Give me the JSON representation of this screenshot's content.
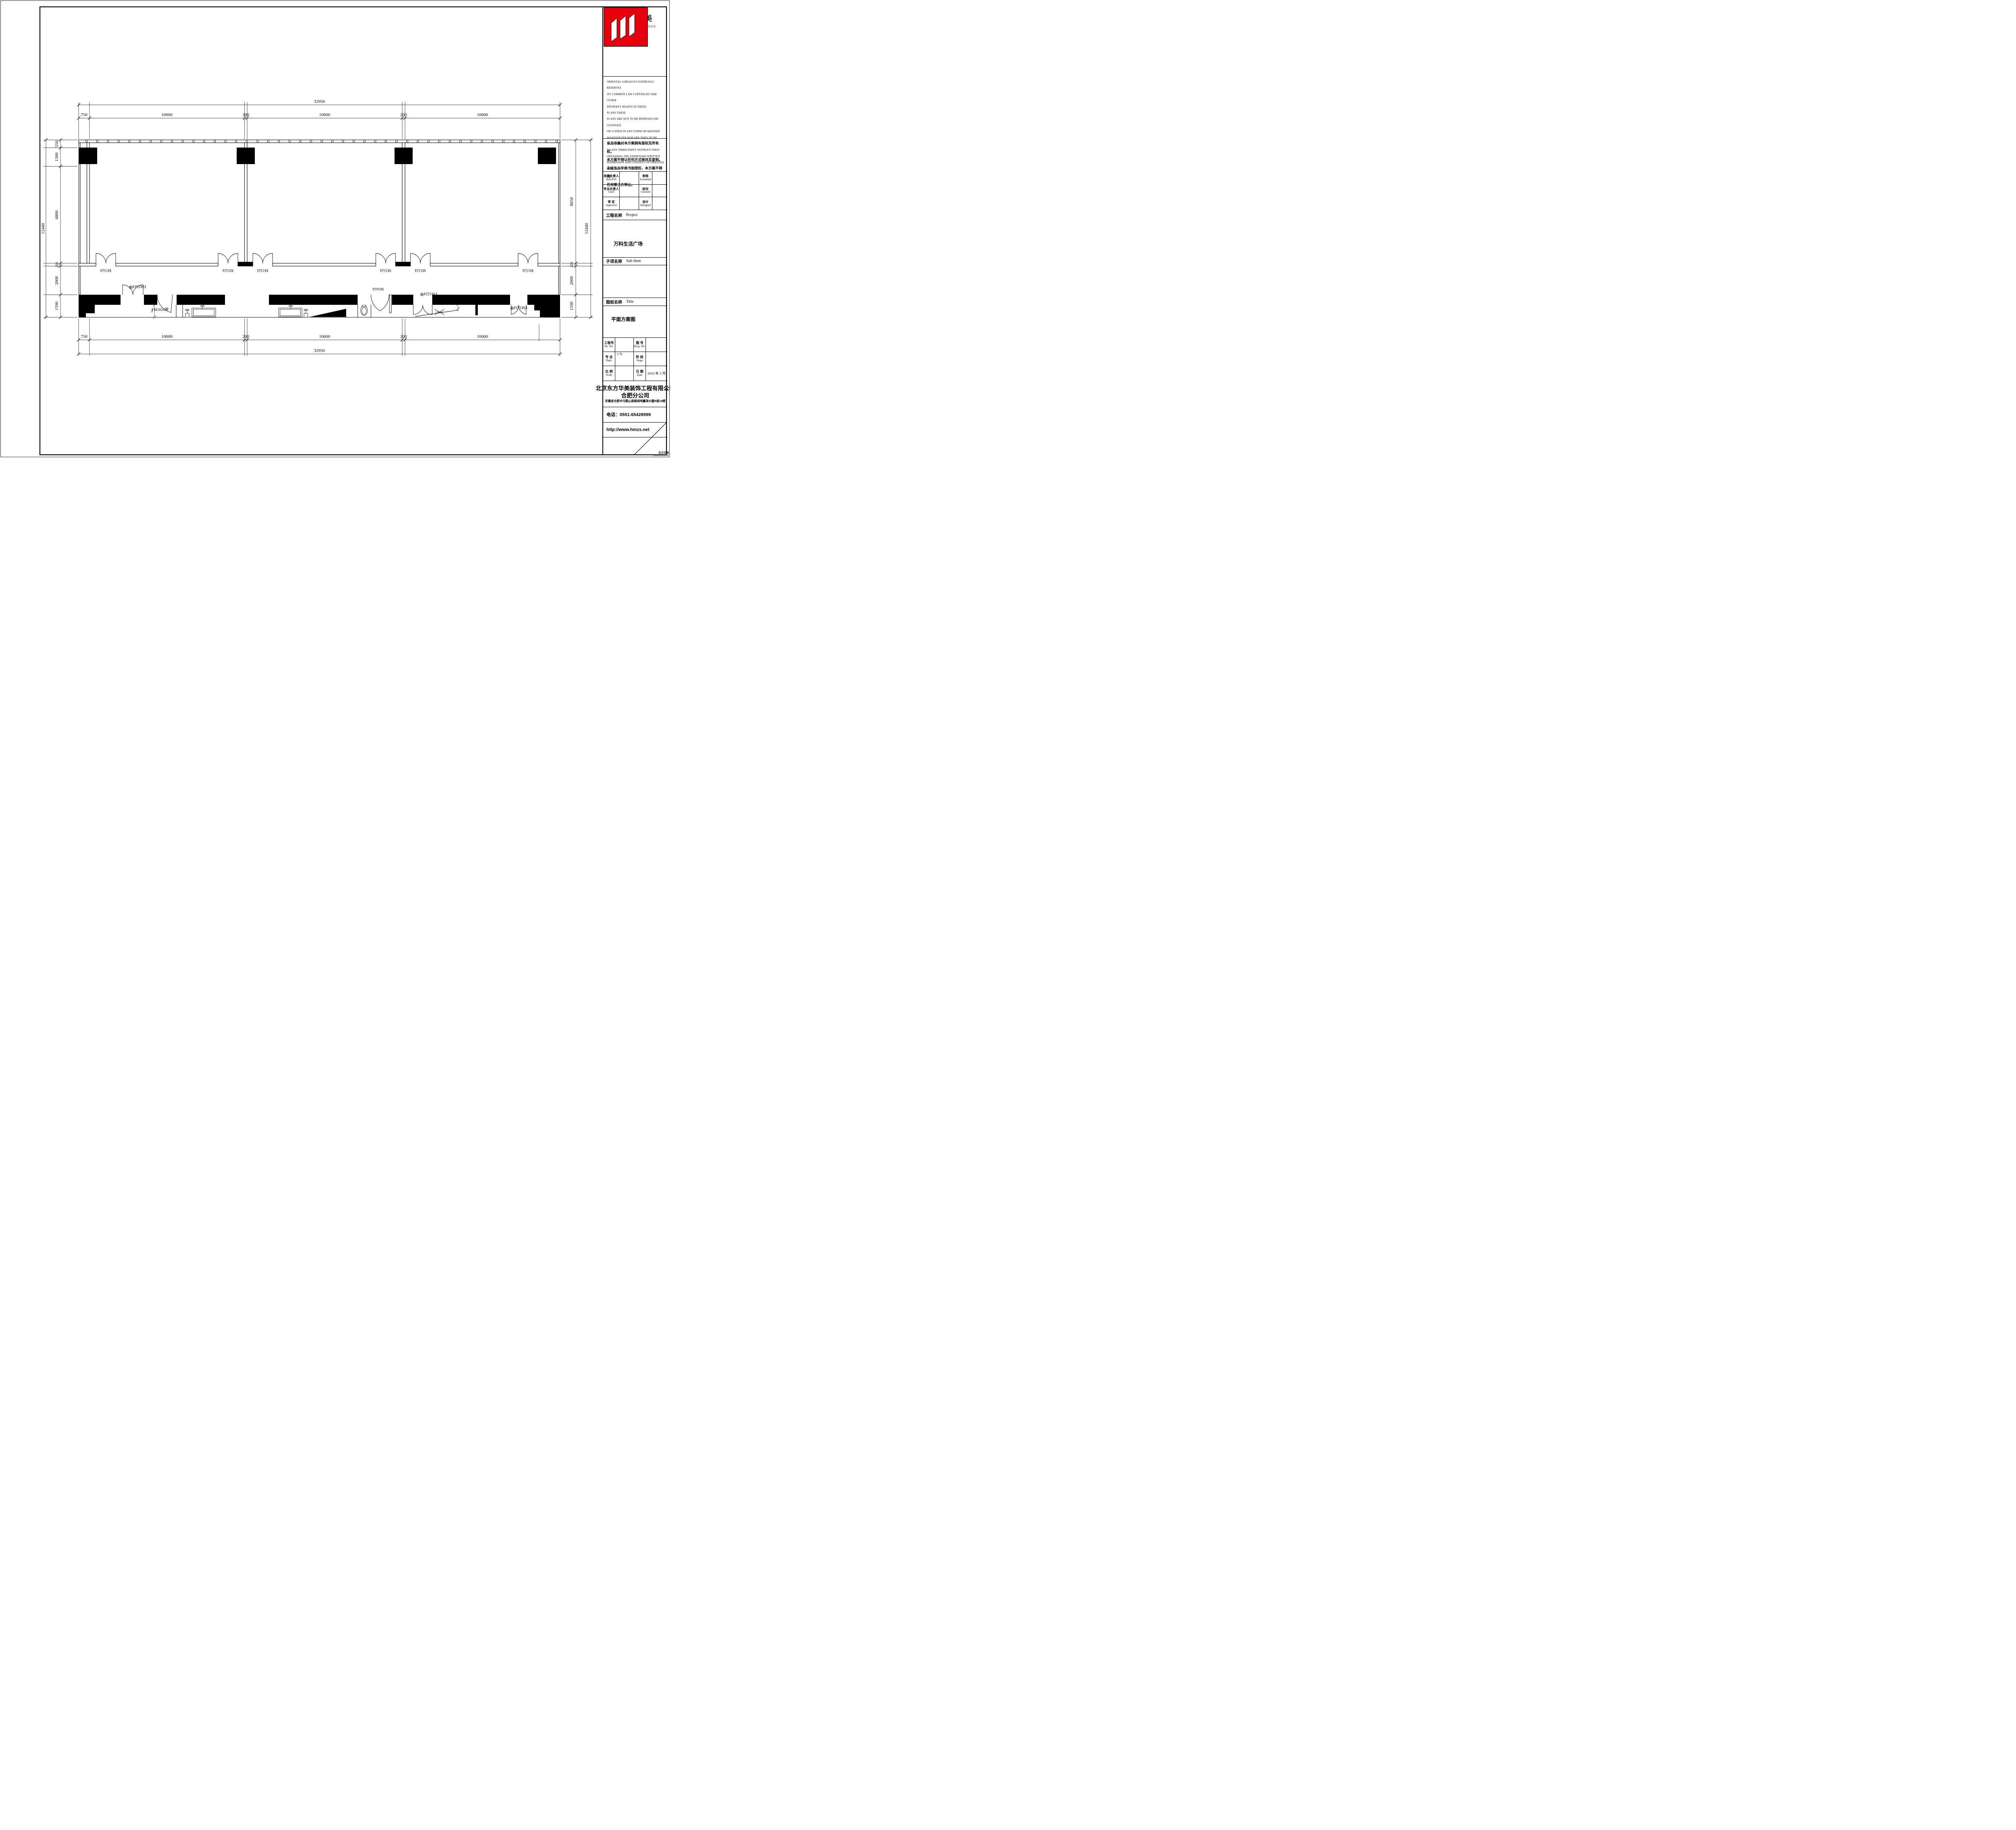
{
  "title_block": {
    "logo": {
      "cn": "东方华美",
      "en": "Oriental Gorgeous",
      "brand_red": "#e8000d"
    },
    "copyright_en_lines": [
      "ORIENTAL GORGEOUS EXPRESSLY RESERVES",
      "ITS COMMON LAW COPYRIGHT AND OTHER",
      "PROPERTY RIGHTS IN THESE PLANS.THESE",
      "PLANS ARE NOT TO BE REPRODUCED CHANGED",
      "OR COPIED IN ANY FORM OR MANNER",
      "WHATSOEVER.NOR ARE THEY TO BE ASSIGHED",
      "TO ANY THIRD PARTY WITHOUT FIRST",
      "OBTAINING THE EXPRESSED WRITTEN",
      "PERMISSION AND CONSENT OF ORIENTAL",
      "GORGEOUS"
    ],
    "copyright_cn_lines": [
      "东方华美对本方案拥有版权及所有权。",
      "本方案不得以任何方式修改及复制。",
      "未经东方华美书面授权，本方案不得向",
      "任何第三方转让。"
    ],
    "personnel": {
      "item_prin_cn": "项目负责人",
      "item_prin_en": "Item.Prin",
      "examined_cn": "审核",
      "examined_en": "Examined",
      "chief_cn": "专业负责人",
      "chief_en": "Chief",
      "checked_cn": "校对",
      "checked_en": "Checked",
      "approved_cn": "审 定",
      "approved_en": "Approved",
      "designed_cn": "设计",
      "designed_en": "Designed"
    },
    "project": {
      "label_cn": "工程名称",
      "label_en": "Project",
      "value": "万科生活广场"
    },
    "sub_item": {
      "label_cn": "子项名称",
      "label_en": "Sub Item",
      "value": ""
    },
    "drawing_title": {
      "label_cn": "图纸名称",
      "label_en": "Title",
      "value": "平面方案图"
    },
    "grid": {
      "pjt_cn": "工程号",
      "pjt_en": "Pjt .No.",
      "pjt_value": "",
      "dwg_cn": "图 号",
      "dwg_en": "Dwg. No.",
      "dwg_value": "",
      "dept_cn": "专 业",
      "dept_en": "Dept.",
      "dept_value": "1:70",
      "stage_cn": "阶 段",
      "stage_en": "Stage",
      "stage_value": "",
      "scale_cn": "比 例",
      "scale_en": "Scale",
      "scale_value": "",
      "date_cn": "日 期",
      "date_en": "Date",
      "date_value": "2016 年 3  月"
    },
    "company": {
      "name": "北京东方华美装饰工程有限公司",
      "branch": "合肥分公司",
      "address": "安徽省合肥市马鞍山南路绿地赢海大厦B座19楼",
      "phone": "电话：0551-65428999",
      "website": "http://www.hmzs.net"
    },
    "corner": {
      "cn": "东方华美",
      "web": "www.hmzs.net"
    }
  },
  "plan": {
    "dims": {
      "overall_h": "32950",
      "h_segments": [
        "750",
        "10600",
        "200",
        "10600",
        "200",
        "10600"
      ],
      "overall_v": "12440",
      "left_segments": [
        "550",
        "1300",
        "6800",
        "200",
        "2000",
        "1590"
      ],
      "right_segments": [
        "8650",
        "200",
        "2000",
        "1590"
      ],
      "small": "760"
    },
    "doors": {
      "m1524": "M1524",
      "fm1524": "FM1524甲",
      "fm1024": "FM1024甲",
      "m1024": "M1024",
      "fm1224": "FM1224甲"
    }
  }
}
